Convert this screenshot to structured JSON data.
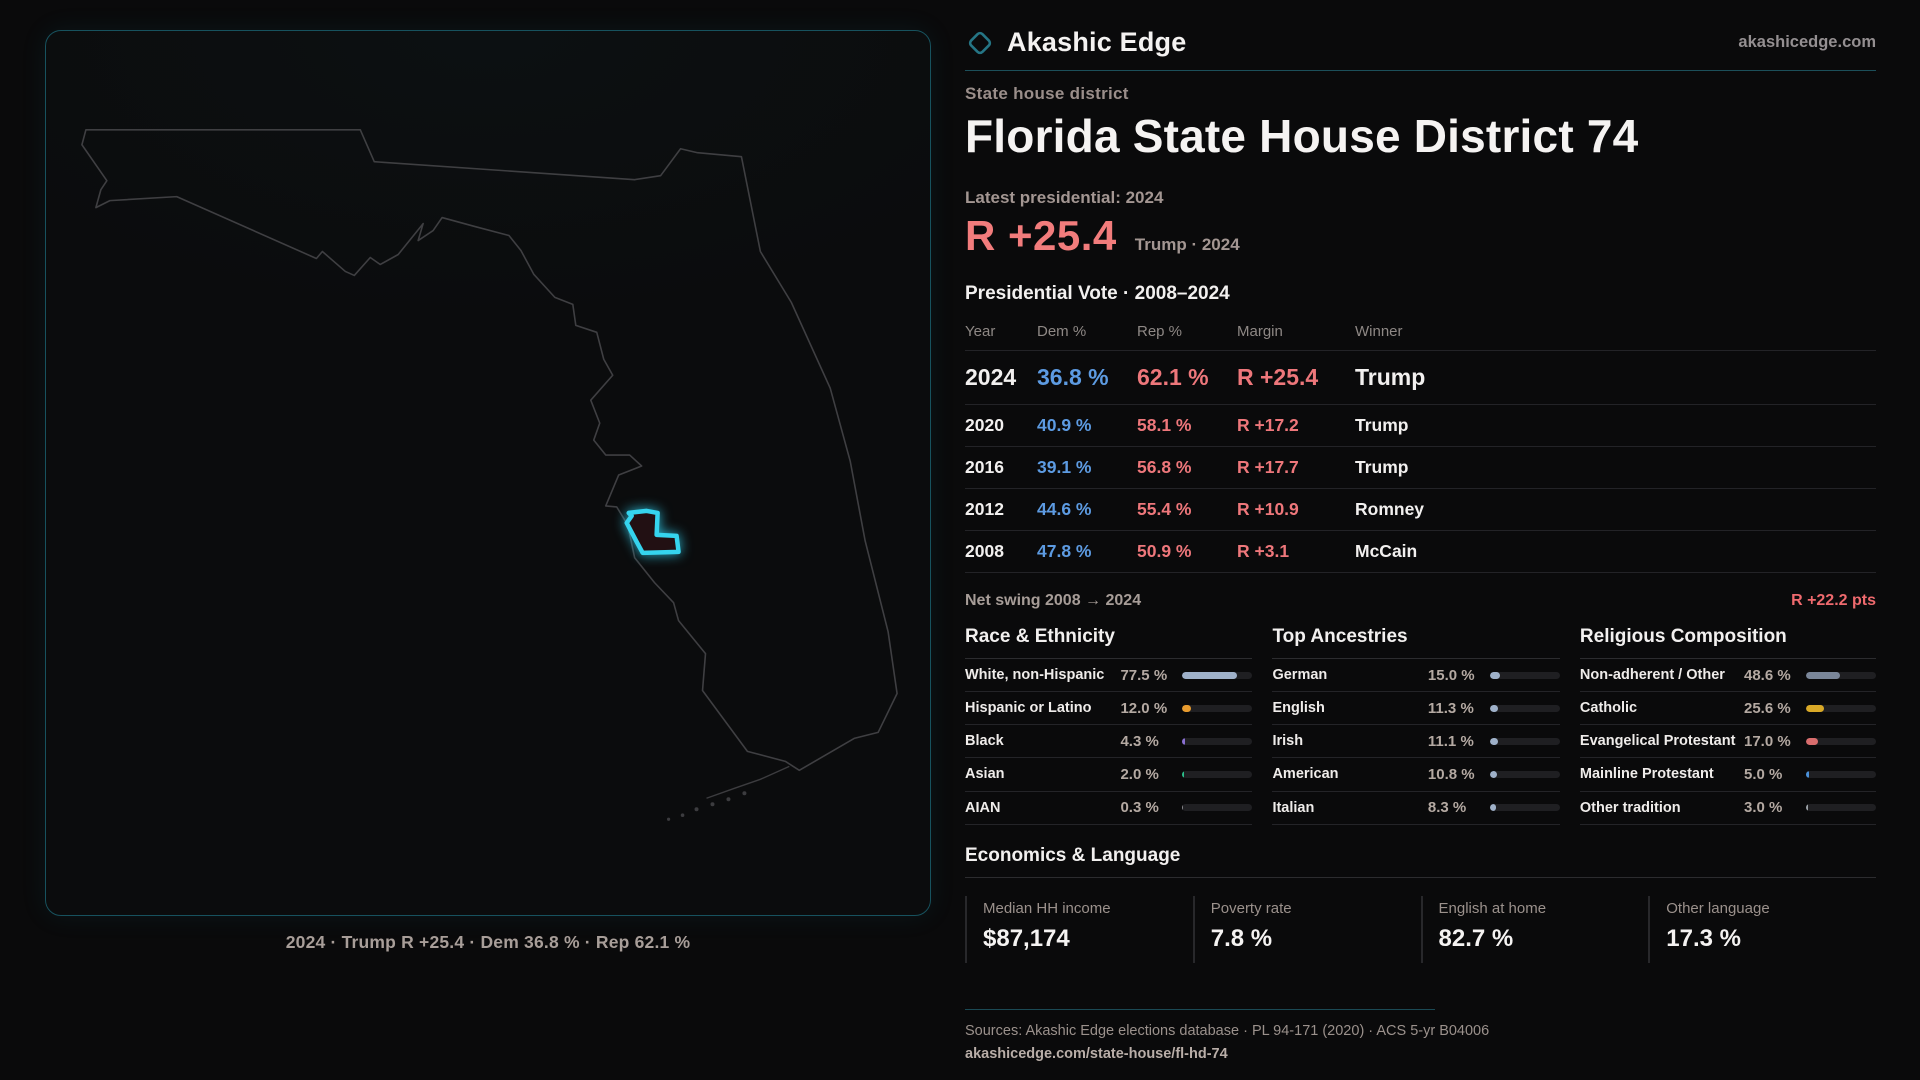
{
  "theme": {
    "accent_red": "#f27c7c",
    "dem_blue": "#5d9be2",
    "rep_red": "#ee777b",
    "teal_border": "#17525e",
    "district_cyan": "#35d4ee"
  },
  "map": {
    "caption": "2024 · Trump R +25.4 · Dem 36.8 % · Rep 62.1 %"
  },
  "header": {
    "brand": "Akashic Edge",
    "site": "akashicedge.com",
    "kicker": "State house district",
    "title": "Florida State House District 74",
    "latest_label": "Latest presidential: 2024",
    "margin_big": "R +25.4",
    "margin_context": "Trump · 2024",
    "table_title": "Presidential Vote · 2008–2024"
  },
  "table": {
    "columns": [
      "Year",
      "Dem %",
      "Rep %",
      "Margin",
      "Winner"
    ],
    "rows": [
      {
        "year": "2024",
        "dem": "36.8 %",
        "rep": "62.1 %",
        "margin": "R +25.4",
        "winner": "Trump"
      },
      {
        "year": "2020",
        "dem": "40.9 %",
        "rep": "58.1 %",
        "margin": "R +17.2",
        "winner": "Trump"
      },
      {
        "year": "2016",
        "dem": "39.1 %",
        "rep": "56.8 %",
        "margin": "R +17.7",
        "winner": "Trump"
      },
      {
        "year": "2012",
        "dem": "44.6 %",
        "rep": "55.4 %",
        "margin": "R +10.9",
        "winner": "Romney"
      },
      {
        "year": "2008",
        "dem": "47.8 %",
        "rep": "50.9 %",
        "margin": "R +3.1",
        "winner": "McCain"
      }
    ],
    "net_swing_label": "Net swing 2008 → 2024",
    "net_swing_value": "R +22.2 pts"
  },
  "demographics": [
    {
      "title": "Race & Ethnicity",
      "rows": [
        {
          "label": "White, non-Hispanic",
          "value": "77.5 %",
          "bar": "77.5%",
          "color": "#9fb1c9"
        },
        {
          "label": "Hispanic or Latino",
          "value": "12.0 %",
          "bar": "12%",
          "color": "#e89b2e"
        },
        {
          "label": "Black",
          "value": "4.3 %",
          "bar": "4.3%",
          "color": "#8a6fd1"
        },
        {
          "label": "Asian",
          "value": "2.0 %",
          "bar": "2%",
          "color": "#2bbf8a"
        },
        {
          "label": "AIAN",
          "value": "0.3 %",
          "bar": "0.3%",
          "color": "#8a8a8e"
        }
      ]
    },
    {
      "title": "Top Ancestries",
      "rows": [
        {
          "label": "German",
          "value": "15.0 %",
          "bar": "15%",
          "color": "#9fb1c9"
        },
        {
          "label": "English",
          "value": "11.3 %",
          "bar": "11.3%",
          "color": "#9fb1c9"
        },
        {
          "label": "Irish",
          "value": "11.1 %",
          "bar": "11.1%",
          "color": "#9fb1c9"
        },
        {
          "label": "American",
          "value": "10.8 %",
          "bar": "10.8%",
          "color": "#9fb1c9"
        },
        {
          "label": "Italian",
          "value": "8.3 %",
          "bar": "8.3%",
          "color": "#9fb1c9"
        }
      ]
    },
    {
      "title": "Religious Composition",
      "rows": [
        {
          "label": "Non-adherent / Other",
          "value": "48.6 %",
          "bar": "48.6%",
          "color": "#7a8699"
        },
        {
          "label": "Catholic",
          "value": "25.6 %",
          "bar": "25.6%",
          "color": "#d9a927"
        },
        {
          "label": "Evangelical Protestant",
          "value": "17.0 %",
          "bar": "17%",
          "color": "#d96d6d"
        },
        {
          "label": "Mainline Protestant",
          "value": "5.0 %",
          "bar": "5%",
          "color": "#4a90d9"
        },
        {
          "label": "Other tradition",
          "value": "3.0 %",
          "bar": "3%",
          "color": "#9aa0a6"
        }
      ]
    }
  ],
  "economics": {
    "title": "Economics & Language",
    "stats": [
      {
        "label": "Median HH income",
        "value": "$87,174"
      },
      {
        "label": "Poverty rate",
        "value": "7.8 %"
      },
      {
        "label": "English at home",
        "value": "82.7 %"
      },
      {
        "label": "Other language",
        "value": "17.3 %"
      }
    ]
  },
  "footer": {
    "sources": "Sources: Akashic Edge elections database · PL 94-171 (2020) · ACS 5-yr B04006",
    "permalink": "akashicedge.com/state-house/fl-hd-74"
  }
}
